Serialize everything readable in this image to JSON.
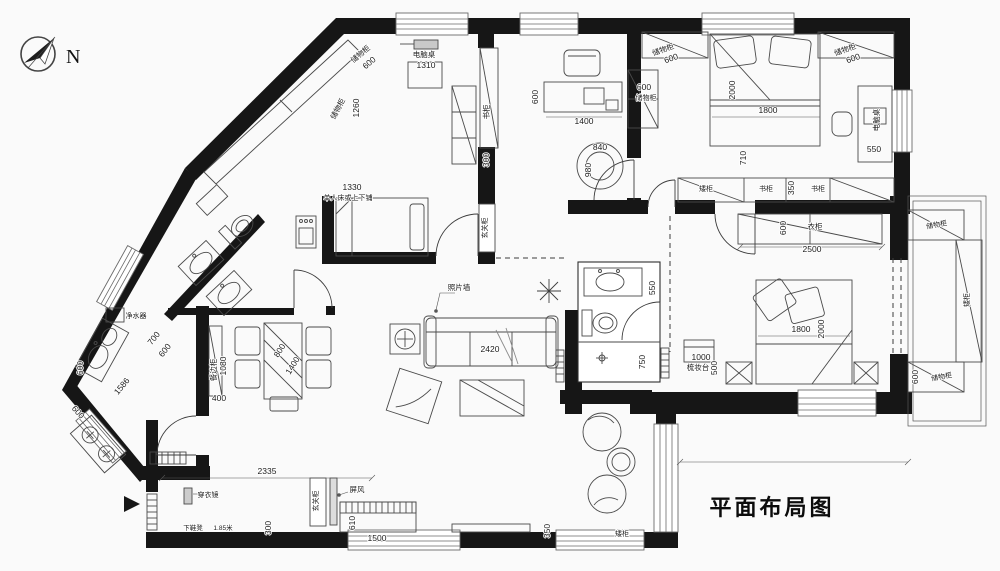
{
  "title": "平面布局图",
  "compass": {
    "label": "N"
  },
  "colors": {
    "wall": "#161616",
    "line": "#4a4a4a",
    "background": "#fafafa"
  },
  "labels": [
    {
      "t": "储物柜",
      "x": 362,
      "y": 56,
      "r": -40,
      "s": 7.5,
      "n": "furn"
    },
    {
      "t": "600",
      "x": 371,
      "y": 65,
      "r": -40,
      "s": 8.5,
      "n": "dim"
    },
    {
      "t": "电脑桌",
      "x": 424,
      "y": 57,
      "s": 7.5,
      "n": "furn"
    },
    {
      "t": "1310",
      "x": 426,
      "y": 68,
      "s": 8.5,
      "n": "dim"
    },
    {
      "t": "储物柜",
      "x": 340,
      "y": 110,
      "r": -62,
      "s": 7.5,
      "n": "furn"
    },
    {
      "t": "1260",
      "x": 359,
      "y": 108,
      "r": -90,
      "s": 8.5,
      "n": "dim"
    },
    {
      "t": "书柜",
      "x": 489,
      "y": 112,
      "r": -90,
      "s": 7.5,
      "n": "furn"
    },
    {
      "t": "300",
      "x": 489,
      "y": 160,
      "r": -90,
      "s": 8.5,
      "n": "dim"
    },
    {
      "t": "玄关柜",
      "x": 487,
      "y": 228,
      "r": -90,
      "s": 7,
      "n": "furn"
    },
    {
      "t": "600",
      "x": 538,
      "y": 97,
      "r": -90,
      "s": 8.5,
      "n": "dim"
    },
    {
      "t": "1400",
      "x": 584,
      "y": 124,
      "s": 8.5,
      "n": "dim"
    },
    {
      "t": "840",
      "x": 600,
      "y": 150,
      "s": 8.5,
      "n": "dim"
    },
    {
      "t": "980",
      "x": 591,
      "y": 170,
      "r": -90,
      "s": 8.5,
      "n": "dim"
    },
    {
      "t": "1330",
      "x": 352,
      "y": 190,
      "s": 8.5,
      "n": "dim"
    },
    {
      "t": "单人床或上下铺",
      "x": 348,
      "y": 200,
      "s": 7,
      "n": "furn"
    },
    {
      "t": "储物柜",
      "x": 664,
      "y": 52,
      "r": -20,
      "s": 7.5,
      "n": "furn"
    },
    {
      "t": "600",
      "x": 672,
      "y": 61,
      "r": -20,
      "s": 8.5,
      "n": "dim"
    },
    {
      "t": "600",
      "x": 644,
      "y": 90,
      "s": 8.5,
      "n": "dim"
    },
    {
      "t": "储物柜",
      "x": 646,
      "y": 100,
      "s": 7,
      "n": "furn"
    },
    {
      "t": "2000",
      "x": 735,
      "y": 90,
      "r": -90,
      "s": 8.5,
      "n": "dim"
    },
    {
      "t": "1800",
      "x": 768,
      "y": 113,
      "s": 8.5,
      "n": "dim"
    },
    {
      "t": "710",
      "x": 746,
      "y": 158,
      "r": -90,
      "s": 8.5,
      "n": "dim"
    },
    {
      "t": "储物柜",
      "x": 846,
      "y": 52,
      "r": -20,
      "s": 7.5,
      "n": "furn"
    },
    {
      "t": "600",
      "x": 854,
      "y": 61,
      "r": -20,
      "s": 8.5,
      "n": "dim"
    },
    {
      "t": "电脑桌",
      "x": 879,
      "y": 120,
      "r": -90,
      "s": 7.5,
      "n": "furn"
    },
    {
      "t": "550",
      "x": 874,
      "y": 152,
      "s": 8.5,
      "n": "dim"
    },
    {
      "t": "矮柜",
      "x": 706,
      "y": 191,
      "s": 7,
      "n": "furn"
    },
    {
      "t": "书柜",
      "x": 766,
      "y": 191,
      "s": 7,
      "n": "furn"
    },
    {
      "t": "350",
      "x": 794,
      "y": 188,
      "r": -90,
      "s": 8.5,
      "n": "dim"
    },
    {
      "t": "书柜",
      "x": 818,
      "y": 191,
      "s": 7,
      "n": "furn"
    },
    {
      "t": "600",
      "x": 786,
      "y": 228,
      "r": -90,
      "s": 8.5,
      "n": "dim"
    },
    {
      "t": "衣柜",
      "x": 815,
      "y": 229,
      "s": 7.5,
      "n": "furn"
    },
    {
      "t": "2500",
      "x": 812,
      "y": 252,
      "s": 8.5,
      "n": "dim"
    },
    {
      "t": "储物柜",
      "x": 937,
      "y": 227,
      "r": -10,
      "s": 7,
      "n": "furn"
    },
    {
      "t": "矮柜",
      "x": 969,
      "y": 300,
      "r": -90,
      "s": 7,
      "n": "furn"
    },
    {
      "t": "600",
      "x": 918,
      "y": 377,
      "r": -90,
      "s": 8.5,
      "n": "dim"
    },
    {
      "t": "储物柜",
      "x": 942,
      "y": 379,
      "r": -10,
      "s": 7,
      "n": "furn"
    },
    {
      "t": "550",
      "x": 655,
      "y": 288,
      "r": -90,
      "s": 8.5,
      "n": "dim"
    },
    {
      "t": "750",
      "x": 645,
      "y": 362,
      "r": -90,
      "s": 8.5,
      "n": "dim"
    },
    {
      "t": "1000",
      "x": 701,
      "y": 360,
      "s": 8.5,
      "n": "dim"
    },
    {
      "t": "梳妆台",
      "x": 698,
      "y": 370,
      "s": 7.5,
      "n": "furn"
    },
    {
      "t": "500",
      "x": 717,
      "y": 368,
      "r": -90,
      "s": 8.5,
      "n": "dim"
    },
    {
      "t": "1800",
      "x": 801,
      "y": 332,
      "s": 8.5,
      "n": "dim"
    },
    {
      "t": "2000",
      "x": 824,
      "y": 329,
      "r": -90,
      "s": 8.5,
      "n": "dim"
    },
    {
      "t": "照片墙",
      "x": 459,
      "y": 290,
      "s": 7.5,
      "n": "furn"
    },
    {
      "t": "2420",
      "x": 490,
      "y": 352,
      "s": 8.5,
      "n": "dim"
    },
    {
      "t": "餐边柜",
      "x": 216,
      "y": 370,
      "r": -90,
      "s": 7.5,
      "n": "furn"
    },
    {
      "t": "1080",
      "x": 226,
      "y": 366,
      "r": -90,
      "s": 8.5,
      "n": "dim"
    },
    {
      "t": "400",
      "x": 219,
      "y": 401,
      "s": 8.5,
      "n": "dim"
    },
    {
      "t": "800",
      "x": 282,
      "y": 352,
      "r": -58,
      "s": 8.5,
      "n": "dim"
    },
    {
      "t": "1400",
      "x": 295,
      "y": 367,
      "r": -58,
      "s": 8.5,
      "n": "dim"
    },
    {
      "t": "净水器",
      "x": 136,
      "y": 318,
      "s": 7,
      "n": "furn"
    },
    {
      "t": "700",
      "x": 156,
      "y": 340,
      "r": -52,
      "s": 8.5,
      "n": "dim"
    },
    {
      "t": "600",
      "x": 167,
      "y": 352,
      "r": -52,
      "s": 8.5,
      "n": "dim"
    },
    {
      "t": "1586",
      "x": 124,
      "y": 388,
      "r": -50,
      "s": 8.5,
      "n": "dim"
    },
    {
      "t": "600",
      "x": 83,
      "y": 368,
      "r": -90,
      "s": 8.5,
      "n": "dim"
    },
    {
      "t": "600",
      "x": 76,
      "y": 414,
      "r": 48,
      "s": 8.5,
      "n": "dim"
    },
    {
      "t": "2335",
      "x": 267,
      "y": 474,
      "s": 8.5,
      "n": "dim"
    },
    {
      "t": "穿衣镜",
      "x": 208,
      "y": 497,
      "s": 7,
      "n": "furn"
    },
    {
      "t": "玄关柜",
      "x": 318,
      "y": 501,
      "r": -90,
      "s": 7,
      "n": "furn"
    },
    {
      "t": "屏风",
      "x": 357,
      "y": 492,
      "s": 7.5,
      "n": "furn"
    },
    {
      "t": "下鞋凳",
      "x": 193,
      "y": 530,
      "s": 6.5,
      "n": "furn"
    },
    {
      "t": "1.85米",
      "x": 223,
      "y": 530,
      "s": 6.5,
      "n": "dim"
    },
    {
      "t": "300",
      "x": 271,
      "y": 528,
      "r": -90,
      "s": 8.5,
      "n": "dim"
    },
    {
      "t": "1500",
      "x": 377,
      "y": 541,
      "s": 8.5,
      "n": "dim"
    },
    {
      "t": "610",
      "x": 355,
      "y": 523,
      "r": -90,
      "s": 8.5,
      "n": "dim"
    },
    {
      "t": "350",
      "x": 550,
      "y": 531,
      "r": -90,
      "s": 8.5,
      "n": "dim"
    },
    {
      "t": "矮柜",
      "x": 622,
      "y": 536,
      "s": 7,
      "n": "furn"
    }
  ]
}
